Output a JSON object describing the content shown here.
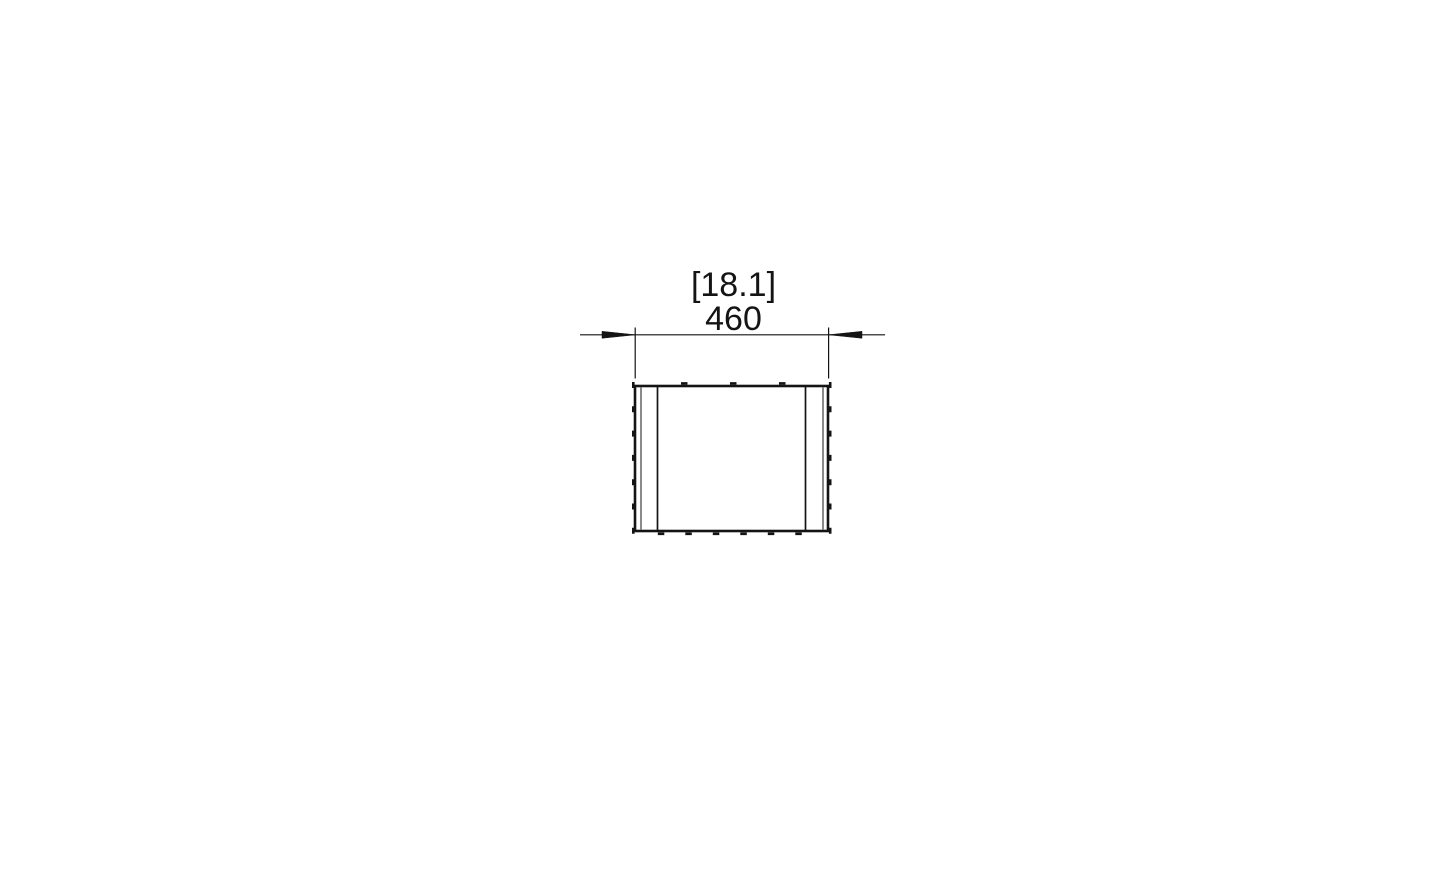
{
  "page": {
    "background_color": "#ffffff"
  },
  "drawing": {
    "line_color": "#141414",
    "dimension": {
      "imperial_label": "[18.1]",
      "metric_label": "460",
      "imperial_value_in": 18.1,
      "metric_value_mm": 460
    }
  }
}
